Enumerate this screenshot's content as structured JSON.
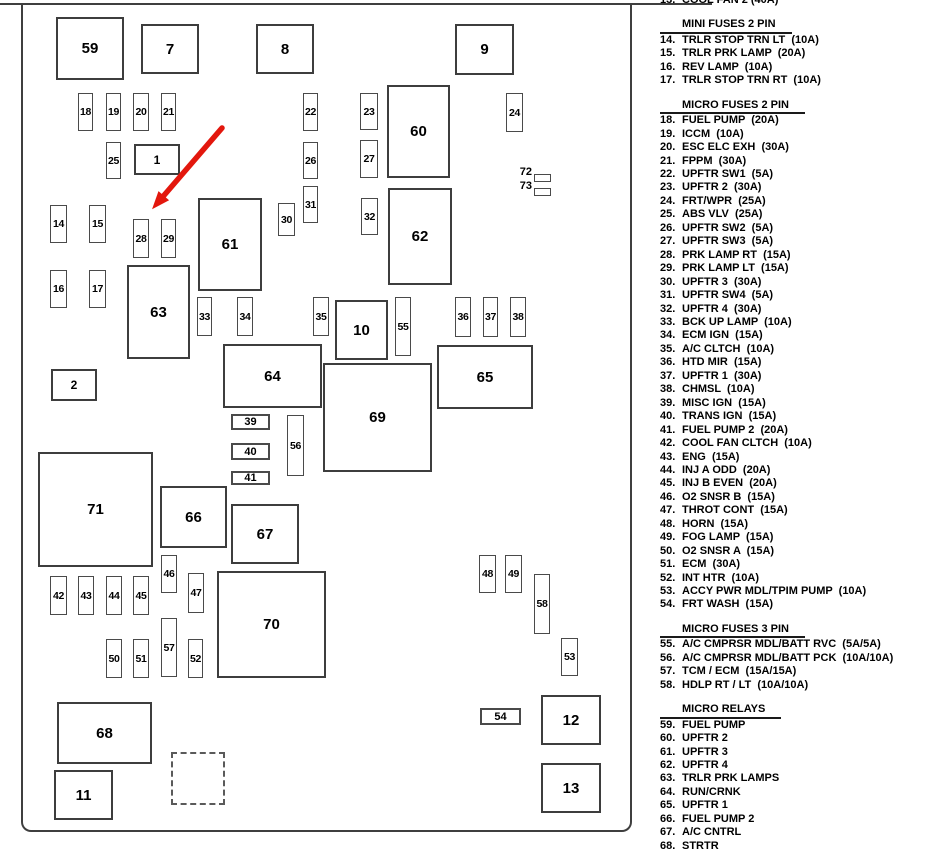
{
  "colors": {
    "line": "#3f3f3f",
    "arrow": "#e3170d",
    "text": "#000000"
  },
  "diagram": {
    "boxes": [
      {
        "n": "59",
        "x": 56,
        "y": 17,
        "w": 68,
        "h": 63,
        "t": "lg"
      },
      {
        "n": "7",
        "x": 141,
        "y": 24,
        "w": 58,
        "h": 50,
        "t": "lg"
      },
      {
        "n": "8",
        "x": 256,
        "y": 24,
        "w": 58,
        "h": 50,
        "t": "lg"
      },
      {
        "n": "9",
        "x": 455,
        "y": 24,
        "w": 59,
        "h": 51,
        "t": "lg"
      },
      {
        "n": "60",
        "x": 387,
        "y": 85,
        "w": 63,
        "h": 93,
        "t": "lg"
      },
      {
        "n": "62",
        "x": 388,
        "y": 188,
        "w": 64,
        "h": 97,
        "t": "lg"
      },
      {
        "n": "61",
        "x": 198,
        "y": 198,
        "w": 64,
        "h": 93,
        "t": "lg"
      },
      {
        "n": "63",
        "x": 127,
        "y": 265,
        "w": 63,
        "h": 94,
        "t": "lg"
      },
      {
        "n": "10",
        "x": 335,
        "y": 300,
        "w": 53,
        "h": 60,
        "t": "lg"
      },
      {
        "n": "64",
        "x": 223,
        "y": 344,
        "w": 99,
        "h": 64,
        "t": "lg"
      },
      {
        "n": "65",
        "x": 437,
        "y": 345,
        "w": 96,
        "h": 64,
        "t": "lg"
      },
      {
        "n": "69",
        "x": 323,
        "y": 363,
        "w": 109,
        "h": 109,
        "t": "lg"
      },
      {
        "n": "71",
        "x": 38,
        "y": 452,
        "w": 115,
        "h": 115,
        "t": "lg"
      },
      {
        "n": "66",
        "x": 160,
        "y": 486,
        "w": 67,
        "h": 62,
        "t": "lg"
      },
      {
        "n": "67",
        "x": 231,
        "y": 504,
        "w": 68,
        "h": 60,
        "t": "lg"
      },
      {
        "n": "70",
        "x": 217,
        "y": 571,
        "w": 109,
        "h": 107,
        "t": "lg"
      },
      {
        "n": "68",
        "x": 57,
        "y": 702,
        "w": 95,
        "h": 62,
        "t": "lg"
      },
      {
        "n": "11",
        "x": 54,
        "y": 770,
        "w": 59,
        "h": 50,
        "t": "lg"
      },
      {
        "n": "12",
        "x": 541,
        "y": 695,
        "w": 60,
        "h": 50,
        "t": "lg"
      },
      {
        "n": "13",
        "x": 541,
        "y": 763,
        "w": 60,
        "h": 50,
        "t": "lg"
      },
      {
        "n": "1",
        "x": 134,
        "y": 144,
        "w": 46,
        "h": 31,
        "t": "md"
      },
      {
        "n": "2",
        "x": 51,
        "y": 369,
        "w": 46,
        "h": 32,
        "t": "md"
      },
      {
        "n": "39",
        "x": 231,
        "y": 414,
        "w": 39,
        "h": 16,
        "t": "wd"
      },
      {
        "n": "40",
        "x": 231,
        "y": 443,
        "w": 39,
        "h": 17,
        "t": "wd"
      },
      {
        "n": "41",
        "x": 231,
        "y": 471,
        "w": 39,
        "h": 14,
        "t": "wd"
      },
      {
        "n": "54",
        "x": 480,
        "y": 708,
        "w": 41,
        "h": 17,
        "t": "wd"
      },
      {
        "n": "18",
        "x": 78,
        "y": 93,
        "w": 15,
        "h": 38,
        "t": "sm"
      },
      {
        "n": "19",
        "x": 106,
        "y": 93,
        "w": 15,
        "h": 38,
        "t": "sm"
      },
      {
        "n": "20",
        "x": 133,
        "y": 93,
        "w": 16,
        "h": 38,
        "t": "sm"
      },
      {
        "n": "21",
        "x": 161,
        "y": 93,
        "w": 15,
        "h": 38,
        "t": "sm"
      },
      {
        "n": "22",
        "x": 303,
        "y": 93,
        "w": 15,
        "h": 38,
        "t": "sm"
      },
      {
        "n": "23",
        "x": 360,
        "y": 93,
        "w": 18,
        "h": 37,
        "t": "sm"
      },
      {
        "n": "24",
        "x": 506,
        "y": 93,
        "w": 17,
        "h": 39,
        "t": "sm"
      },
      {
        "n": "25",
        "x": 106,
        "y": 142,
        "w": 15,
        "h": 37,
        "t": "sm"
      },
      {
        "n": "26",
        "x": 303,
        "y": 142,
        "w": 15,
        "h": 37,
        "t": "sm"
      },
      {
        "n": "27",
        "x": 360,
        "y": 140,
        "w": 18,
        "h": 38,
        "t": "sm"
      },
      {
        "n": "30",
        "x": 278,
        "y": 203,
        "w": 17,
        "h": 33,
        "t": "sm"
      },
      {
        "n": "31",
        "x": 303,
        "y": 186,
        "w": 15,
        "h": 37,
        "t": "sm"
      },
      {
        "n": "32",
        "x": 361,
        "y": 198,
        "w": 17,
        "h": 37,
        "t": "sm"
      },
      {
        "n": "14",
        "x": 50,
        "y": 205,
        "w": 17,
        "h": 38,
        "t": "sm"
      },
      {
        "n": "15",
        "x": 89,
        "y": 205,
        "w": 17,
        "h": 38,
        "t": "sm"
      },
      {
        "n": "28",
        "x": 133,
        "y": 219,
        "w": 16,
        "h": 39,
        "t": "sm"
      },
      {
        "n": "29",
        "x": 161,
        "y": 219,
        "w": 15,
        "h": 39,
        "t": "sm"
      },
      {
        "n": "16",
        "x": 50,
        "y": 270,
        "w": 17,
        "h": 38,
        "t": "sm"
      },
      {
        "n": "17",
        "x": 89,
        "y": 270,
        "w": 17,
        "h": 38,
        "t": "sm"
      },
      {
        "n": "33",
        "x": 197,
        "y": 297,
        "w": 15,
        "h": 39,
        "t": "sm"
      },
      {
        "n": "34",
        "x": 237,
        "y": 297,
        "w": 16,
        "h": 39,
        "t": "sm"
      },
      {
        "n": "35",
        "x": 313,
        "y": 297,
        "w": 16,
        "h": 39,
        "t": "sm"
      },
      {
        "n": "36",
        "x": 455,
        "y": 297,
        "w": 16,
        "h": 40,
        "t": "sm"
      },
      {
        "n": "37",
        "x": 483,
        "y": 297,
        "w": 15,
        "h": 40,
        "t": "sm"
      },
      {
        "n": "38",
        "x": 510,
        "y": 297,
        "w": 16,
        "h": 40,
        "t": "sm"
      },
      {
        "n": "55",
        "x": 395,
        "y": 297,
        "w": 16,
        "h": 59,
        "t": "sm"
      },
      {
        "n": "56",
        "x": 287,
        "y": 415,
        "w": 17,
        "h": 61,
        "t": "sm"
      },
      {
        "n": "46",
        "x": 161,
        "y": 555,
        "w": 16,
        "h": 38,
        "t": "sm"
      },
      {
        "n": "47",
        "x": 188,
        "y": 573,
        "w": 16,
        "h": 40,
        "t": "sm"
      },
      {
        "n": "42",
        "x": 50,
        "y": 576,
        "w": 17,
        "h": 39,
        "t": "sm"
      },
      {
        "n": "43",
        "x": 78,
        "y": 576,
        "w": 16,
        "h": 39,
        "t": "sm"
      },
      {
        "n": "44",
        "x": 106,
        "y": 576,
        "w": 16,
        "h": 39,
        "t": "sm"
      },
      {
        "n": "45",
        "x": 133,
        "y": 576,
        "w": 16,
        "h": 39,
        "t": "sm"
      },
      {
        "n": "48",
        "x": 479,
        "y": 555,
        "w": 17,
        "h": 38,
        "t": "sm"
      },
      {
        "n": "49",
        "x": 505,
        "y": 555,
        "w": 17,
        "h": 38,
        "t": "sm"
      },
      {
        "n": "58",
        "x": 534,
        "y": 574,
        "w": 16,
        "h": 60,
        "t": "sm"
      },
      {
        "n": "50",
        "x": 106,
        "y": 639,
        "w": 16,
        "h": 39,
        "t": "sm"
      },
      {
        "n": "51",
        "x": 133,
        "y": 639,
        "w": 16,
        "h": 39,
        "t": "sm"
      },
      {
        "n": "57",
        "x": 161,
        "y": 618,
        "w": 16,
        "h": 59,
        "t": "sm"
      },
      {
        "n": "52",
        "x": 188,
        "y": 639,
        "w": 15,
        "h": 39,
        "t": "sm"
      },
      {
        "n": "53",
        "x": 561,
        "y": 638,
        "w": 17,
        "h": 38,
        "t": "sm"
      },
      {
        "n": "",
        "x": 171,
        "y": 752,
        "w": 54,
        "h": 53,
        "t": "dash"
      }
    ],
    "indicators": [
      {
        "n": "72",
        "lx": 504,
        "ly": 166,
        "rx": 534,
        "ry": 174,
        "rw": 17,
        "rh": 8
      },
      {
        "n": "73",
        "lx": 504,
        "ly": 180,
        "rx": 534,
        "ry": 188,
        "rw": 17,
        "rh": 8
      }
    ],
    "arrow": {
      "x1": 222,
      "y1": 128,
      "x2": 154,
      "y2": 207
    }
  },
  "legend": {
    "sections": [
      {
        "header": "",
        "items": [
          {
            "num": "13.",
            "label": "COOL FAN 2 (40A)"
          }
        ]
      },
      {
        "header": "MINI FUSES 2 PIN",
        "items": [
          {
            "num": "14.",
            "label": "TRLR STOP TRN LT  (10A)"
          },
          {
            "num": "15.",
            "label": "TRLR PRK LAMP  (20A)"
          },
          {
            "num": "16.",
            "label": "REV LAMP  (10A)"
          },
          {
            "num": "17.",
            "label": "TRLR STOP TRN RT  (10A)"
          }
        ]
      },
      {
        "header": "MICRO FUSES 2 PIN",
        "items": [
          {
            "num": "18.",
            "label": "FUEL PUMP  (20A)"
          },
          {
            "num": "19.",
            "label": "ICCM  (10A)"
          },
          {
            "num": "20.",
            "label": "ESC ELC EXH  (30A)"
          },
          {
            "num": "21.",
            "label": "FPPM  (30A)"
          },
          {
            "num": "22.",
            "label": "UPFTR SW1  (5A)"
          },
          {
            "num": "23.",
            "label": "UPFTR 2  (30A)"
          },
          {
            "num": "24.",
            "label": "FRT/WPR  (25A)"
          },
          {
            "num": "25.",
            "label": "ABS VLV  (25A)"
          },
          {
            "num": "26.",
            "label": "UPFTR SW2  (5A)"
          },
          {
            "num": "27.",
            "label": "UPFTR SW3  (5A)"
          },
          {
            "num": "28.",
            "label": "PRK LAMP RT  (15A)"
          },
          {
            "num": "29.",
            "label": "PRK LAMP LT  (15A)"
          },
          {
            "num": "30.",
            "label": "UPFTR 3  (30A)"
          },
          {
            "num": "31.",
            "label": "UPFTR SW4  (5A)"
          },
          {
            "num": "32.",
            "label": "UPFTR 4  (30A)"
          },
          {
            "num": "33.",
            "label": "BCK UP LAMP  (10A)"
          },
          {
            "num": "34.",
            "label": "ECM IGN  (15A)"
          },
          {
            "num": "35.",
            "label": "A/C CLTCH  (10A)"
          },
          {
            "num": "36.",
            "label": "HTD MIR  (15A)"
          },
          {
            "num": "37.",
            "label": "UPFTR 1  (30A)"
          },
          {
            "num": "38.",
            "label": "CHMSL  (10A)"
          },
          {
            "num": "39.",
            "label": "MISC IGN  (15A)"
          },
          {
            "num": "40.",
            "label": "TRANS IGN  (15A)"
          },
          {
            "num": "41.",
            "label": "FUEL PUMP 2  (20A)"
          },
          {
            "num": "42.",
            "label": "COOL FAN CLTCH  (10A)"
          },
          {
            "num": "43.",
            "label": "ENG  (15A)"
          },
          {
            "num": "44.",
            "label": "INJ A ODD  (20A)"
          },
          {
            "num": "45.",
            "label": "INJ B EVEN  (20A)"
          },
          {
            "num": "46.",
            "label": "O2 SNSR B  (15A)"
          },
          {
            "num": "47.",
            "label": "THROT CONT  (15A)"
          },
          {
            "num": "48.",
            "label": "HORN  (15A)"
          },
          {
            "num": "49.",
            "label": "FOG LAMP  (15A)"
          },
          {
            "num": "50.",
            "label": "O2 SNSR A  (15A)"
          },
          {
            "num": "51.",
            "label": "ECM  (30A)"
          },
          {
            "num": "52.",
            "label": "INT HTR  (10A)"
          },
          {
            "num": "53.",
            "label": "ACCY PWR MDL/TPIM PUMP  (10A)"
          },
          {
            "num": "54.",
            "label": "FRT WASH  (15A)"
          }
        ]
      },
      {
        "header": "MICRO FUSES 3 PIN",
        "items": [
          {
            "num": "55.",
            "label": "A/C CMPRSR MDL/BATT RVC  (5A/5A)"
          },
          {
            "num": "56.",
            "label": "A/C CMPRSR MDL/BATT PCK  (10A/10A)"
          },
          {
            "num": "57.",
            "label": "TCM / ECM  (15A/15A)"
          },
          {
            "num": "58.",
            "label": "HDLP RT / LT  (10A/10A)"
          }
        ]
      },
      {
        "header": "MICRO RELAYS",
        "items": [
          {
            "num": "59.",
            "label": "FUEL PUMP"
          },
          {
            "num": "60.",
            "label": "UPFTR 2"
          },
          {
            "num": "61.",
            "label": "UPFTR 3"
          },
          {
            "num": "62.",
            "label": "UPFTR 4"
          },
          {
            "num": "63.",
            "label": "TRLR PRK LAMPS"
          },
          {
            "num": "64.",
            "label": "RUN/CRNK"
          },
          {
            "num": "65.",
            "label": "UPFTR 1"
          },
          {
            "num": "66.",
            "label": "FUEL PUMP 2"
          },
          {
            "num": "67.",
            "label": "A/C CNTRL"
          },
          {
            "num": "68.",
            "label": "STRTR"
          }
        ]
      }
    ]
  }
}
